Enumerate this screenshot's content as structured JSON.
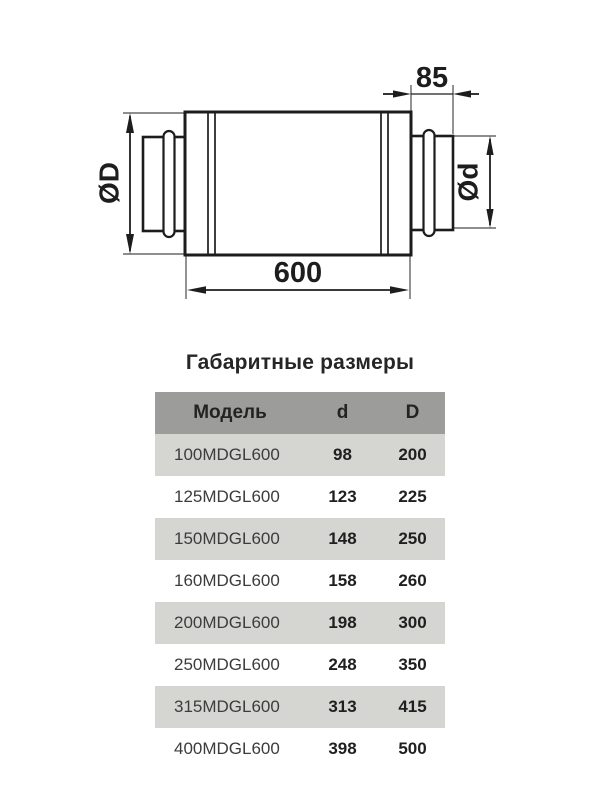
{
  "drawing": {
    "dim_body_length": "600",
    "dim_spigot_length": "85",
    "dim_body_diameter": "ØD",
    "dim_spigot_diameter": "Ød",
    "line_color": "#1c1c1c"
  },
  "section_title": "Габаритные размеры",
  "table": {
    "headers": {
      "model": "Модель",
      "d": "d",
      "D": "D"
    },
    "rows": [
      {
        "model": "100MDGL600",
        "d": "98",
        "D": "200"
      },
      {
        "model": "125MDGL600",
        "d": "123",
        "D": "225"
      },
      {
        "model": "150MDGL600",
        "d": "148",
        "D": "250"
      },
      {
        "model": "160MDGL600",
        "d": "158",
        "D": "260"
      },
      {
        "model": "200MDGL600",
        "d": "198",
        "D": "300"
      },
      {
        "model": "250MDGL600",
        "d": "248",
        "D": "350"
      },
      {
        "model": "315MDGL600",
        "d": "313",
        "D": "415"
      },
      {
        "model": "400MDGL600",
        "d": "398",
        "D": "500"
      }
    ]
  },
  "colors": {
    "table_header_bg": "#9c9c9a",
    "table_stripe_bg": "#d5d5d1",
    "drawing_lines": "#1c1c1c",
    "text_primary": "#1f1f1f",
    "text_secondary": "#3c3c3c"
  }
}
